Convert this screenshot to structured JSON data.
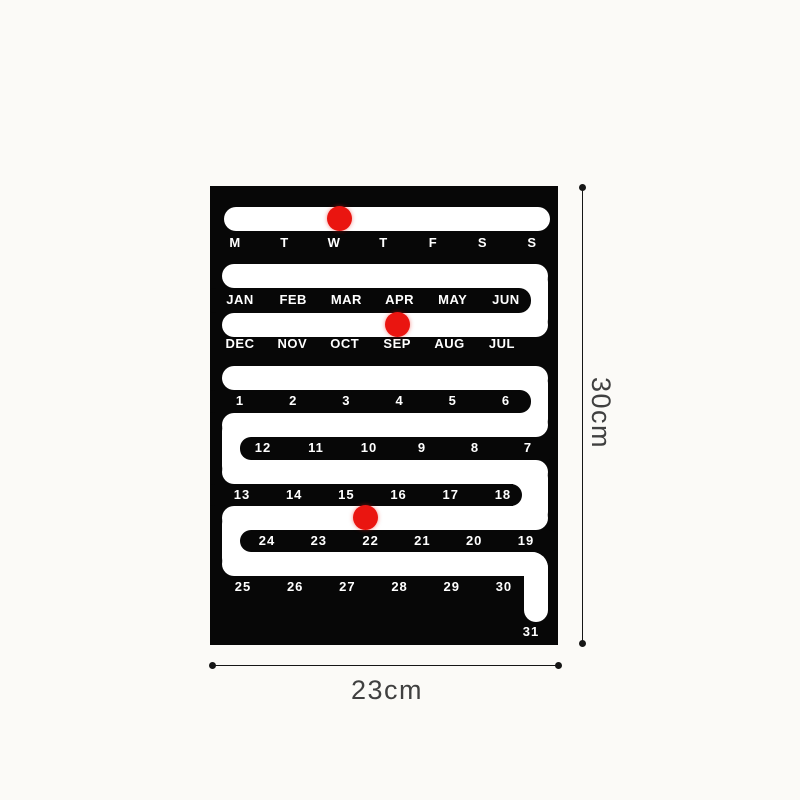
{
  "poster": {
    "weekdays": [
      "M",
      "T",
      "W",
      "T",
      "F",
      "S",
      "S"
    ],
    "months_top": [
      "JAN",
      "FEB",
      "MAR",
      "APR",
      "MAY",
      "JUN"
    ],
    "months_bottom": [
      "DEC",
      "NOV",
      "OCT",
      "SEP",
      "AUG",
      "JUL"
    ],
    "dates_r1": [
      "1",
      "2",
      "3",
      "4",
      "5",
      "6"
    ],
    "dates_r2": [
      "12",
      "11",
      "10",
      "9",
      "8",
      "7"
    ],
    "dates_r3": [
      "13",
      "14",
      "15",
      "16",
      "17",
      "18"
    ],
    "dates_r4": [
      "24",
      "23",
      "22",
      "21",
      "20",
      "19"
    ],
    "dates_r5": [
      "25",
      "26",
      "27",
      "28",
      "29",
      "30"
    ],
    "date_last": "31",
    "markers": {
      "weekday": "W",
      "month": "SEP",
      "date": "22"
    }
  },
  "dimensions": {
    "height": "30cm",
    "width": "23cm"
  },
  "colors": {
    "page_bg": "#fbfaf7",
    "poster": "#070707",
    "track": "#ffffff",
    "marker": "#ea1510"
  }
}
